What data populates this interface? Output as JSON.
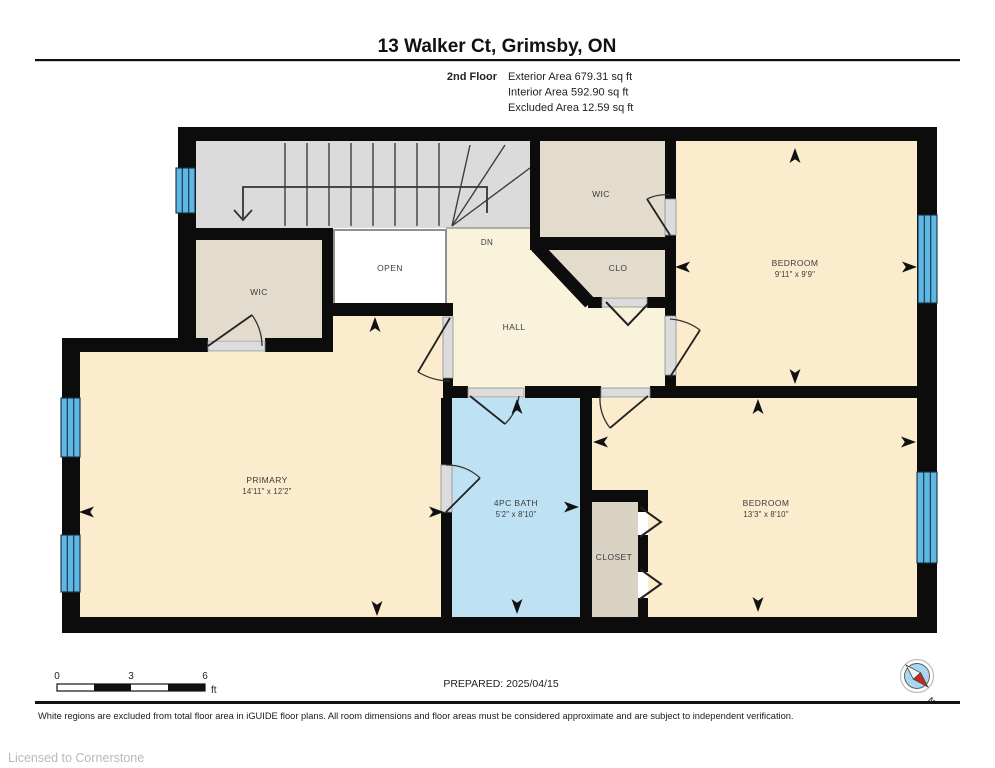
{
  "header": {
    "title": "13 Walker Ct, Grimsby, ON",
    "floor_label": "2nd Floor",
    "areas": [
      "Exterior Area 679.31 sq ft",
      "Interior Area 592.90 sq ft",
      "Excluded Area 12.59 sq ft"
    ]
  },
  "rooms": {
    "wic_left": {
      "label": "WIC"
    },
    "open_area": {
      "label": "OPEN"
    },
    "stairs": {
      "label": "DN"
    },
    "wic_top": {
      "label": "WIC"
    },
    "clo": {
      "label": "CLO"
    },
    "hall": {
      "label": "HALL"
    },
    "bedroom_1": {
      "label": "BEDROOM",
      "dims": "9'11\" x 9'9\""
    },
    "primary": {
      "label": "PRIMARY",
      "dims": "14'11\" x 12'2\""
    },
    "bath": {
      "label": "4PC BATH",
      "dims": "5'2\" x 8'10\""
    },
    "closet": {
      "label": "CLOSET"
    },
    "bedroom_2": {
      "label": "BEDROOM",
      "dims": "13'3\" x 8'10\""
    }
  },
  "scale_bar": {
    "tick_0": "0",
    "tick_3": "3",
    "tick_6": "6",
    "unit": "ft"
  },
  "prepared": "PREPARED: 2025/04/15",
  "compass": {
    "north_label": "N"
  },
  "footer": {
    "disclaimer": "White regions are excluded from total floor area in iGUIDE floor plans. All room dimensions and floor areas must be considered approximate and are subject to independent verification.",
    "license": "Licensed to Cornerstone"
  },
  "colors": {
    "wall": "#0c0c0c",
    "room_fill": "#faeccc",
    "hall_fill": "#faf3dc",
    "closet_fill": "#e3dbcb",
    "stairs_fill": "#dbdbdb",
    "bath_fill": "#bee2f4",
    "window_fill": "#5fb7e5",
    "excluded_fill": "#ffffff",
    "compass_red": "#c9271e",
    "compass_blue": "#a9d7f2"
  }
}
